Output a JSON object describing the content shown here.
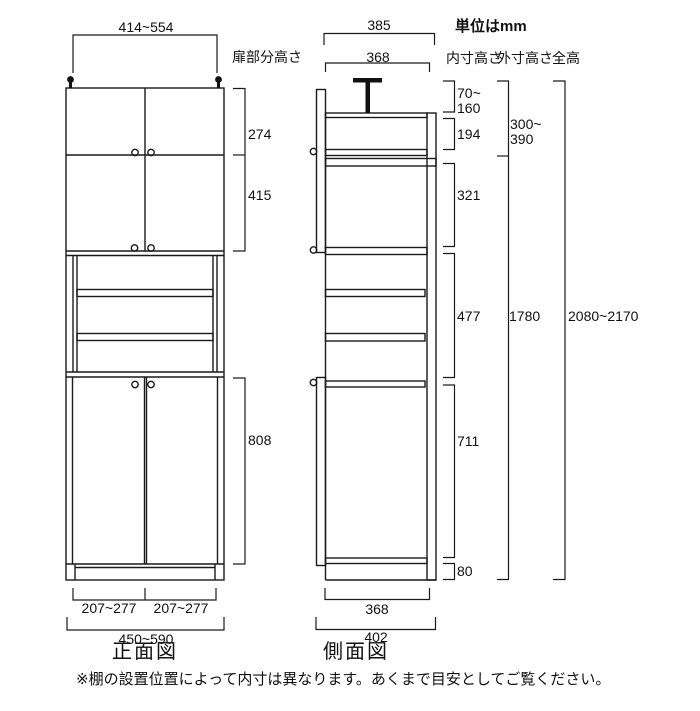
{
  "header": {
    "unit_note": "単位はmm",
    "columns": {
      "inner": "内寸高さ",
      "outer": "外寸高さ",
      "total": "全高"
    }
  },
  "front_view": {
    "caption": "正面図",
    "door_section_label": "扉部分高さ",
    "dims": {
      "top_width": "414~554",
      "upper_door_1": "274",
      "upper_door_2": "415",
      "lower_door": "808",
      "bottom_left": "207~277",
      "bottom_right": "207~277",
      "bottom_total": "450~590"
    }
  },
  "side_view": {
    "caption": "側面図",
    "dims": {
      "top_outer": "385",
      "top_inner": "368",
      "bottom_inner": "368",
      "bottom_outer": "402"
    }
  },
  "heights": {
    "inner": [
      "70~\n160",
      "194",
      "321",
      "477",
      "711",
      "80"
    ],
    "outer": [
      "300~\n390",
      "1780"
    ],
    "total": "2080~2170"
  },
  "footnote": "※棚の設置位置によって内寸は異なります。あくまで目安としてご覧ください。"
}
